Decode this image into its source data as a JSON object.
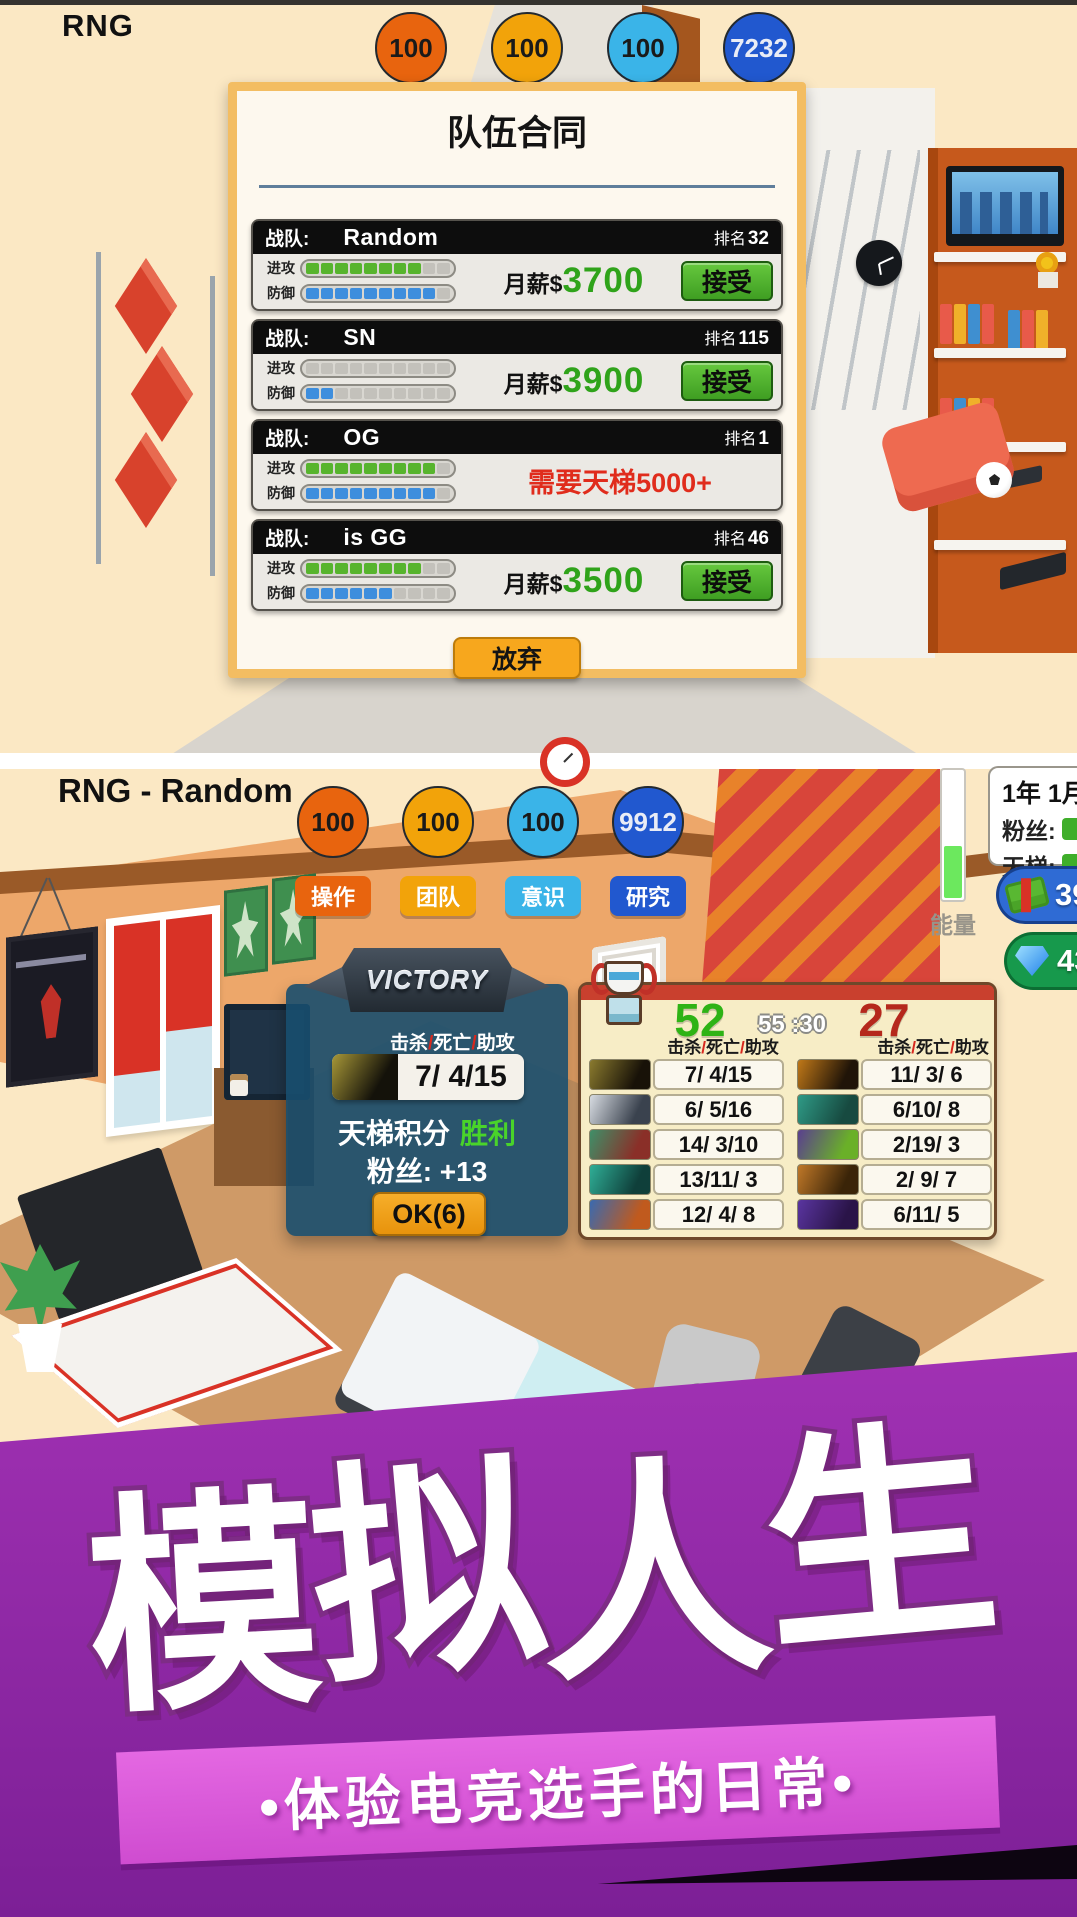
{
  "top": {
    "player_tag": "RNG",
    "badges": [
      {
        "value": "100",
        "bg": "#e8640e",
        "text_color": "#1a1a1a"
      },
      {
        "value": "100",
        "bg": "#f2a30a",
        "text_color": "#1a1a1a"
      },
      {
        "value": "100",
        "bg": "#3ab4e8",
        "text_color": "#1a1a1a"
      },
      {
        "value": "7232",
        "bg": "#2158cf",
        "text_color": "#e9ecf6"
      }
    ],
    "dialog": {
      "title": "队伍合同",
      "team_label": "战队:",
      "rank_label": "排名",
      "attack_label": "进攻",
      "defense_label": "防御",
      "salary_label": "月薪$",
      "accept_label": "接受",
      "give_up_label": "放弃",
      "teams": [
        {
          "name": "Random",
          "rank": "32",
          "attack": 8,
          "defense": 9,
          "salary": "3700"
        },
        {
          "name": "SN",
          "rank": "115",
          "attack": 0,
          "defense": 2,
          "salary": "3900"
        },
        {
          "name": "OG",
          "rank": "1",
          "attack": 9,
          "defense": 9,
          "requirement": "需要天梯5000+"
        },
        {
          "name": "is GG",
          "rank": "46",
          "attack": 8,
          "defense": 6,
          "salary": "3500"
        }
      ]
    }
  },
  "mid": {
    "player_tag": "RNG - Random",
    "badges": [
      {
        "value": "100",
        "label": "操作",
        "bg": "#e8640e",
        "text_color": "#1a1a1a"
      },
      {
        "value": "100",
        "label": "团队",
        "bg": "#f2a30a",
        "text_color": "#1a1a1a"
      },
      {
        "value": "100",
        "label": "意识",
        "bg": "#3ab4e8",
        "text_color": "#1a1a1a"
      },
      {
        "value": "9912",
        "label": "研究",
        "bg": "#2158cf",
        "text_color": "#e9ecf6"
      }
    ],
    "hud": {
      "date": "1年 1月",
      "fans_label": "粉丝:",
      "ladder_label": "天梯:",
      "energy_label": "能量",
      "money_value": "39",
      "gem_value": "43"
    },
    "victory": {
      "banner": "VICTORY",
      "kda_header": "击杀/死亡/助攻",
      "kda": "7/ 4/15",
      "ladder_label": "天梯积分",
      "ladder_value": "胜利",
      "fans_label": "粉丝:",
      "fans_value": "+13",
      "ok_label": "OK(6)"
    },
    "scoreboard": {
      "left_score": "52",
      "timer": "55 :30",
      "right_score": "27",
      "kda_header": "击杀/死亡/助攻",
      "left_rows": [
        {
          "kda": "7/ 4/15",
          "c1": "#8a7a2e",
          "c2": "#181208"
        },
        {
          "kda": "6/ 5/16",
          "c1": "#d8dce2",
          "c2": "#3a424e"
        },
        {
          "kda": "14/ 3/10",
          "c1": "#3f8f68",
          "c2": "#8a2f28"
        },
        {
          "kda": "13/11/ 3",
          "c1": "#2fae96",
          "c2": "#0f3f3a"
        },
        {
          "kda": "12/ 4/ 8",
          "c1": "#3a6ab0",
          "c2": "#c05a1e"
        }
      ],
      "right_rows": [
        {
          "kda": "11/ 3/ 6",
          "c1": "#c07818",
          "c2": "#201408"
        },
        {
          "kda": "6/10/ 8",
          "c1": "#2f9a86",
          "c2": "#174a40"
        },
        {
          "kda": "2/19/ 3",
          "c1": "#5a3f8f",
          "c2": "#6ab028"
        },
        {
          "kda": "2/ 9/ 7",
          "c1": "#c07828",
          "c2": "#3a2408"
        },
        {
          "kda": "6/11/ 5",
          "c1": "#5a35a0",
          "c2": "#2a1448"
        }
      ]
    }
  },
  "banner": {
    "title": "模拟人生",
    "subtitle": "•体验电竞选手的日常•"
  },
  "colors": {
    "accent_orange": "#f7a71d",
    "accept_green": "#4caf2e",
    "salary_green": "#2fa31a",
    "requirement_red": "#e02c1c",
    "score_green": "#2eb315",
    "score_red": "#b5281c",
    "banner_magenta": "#c843cc"
  }
}
